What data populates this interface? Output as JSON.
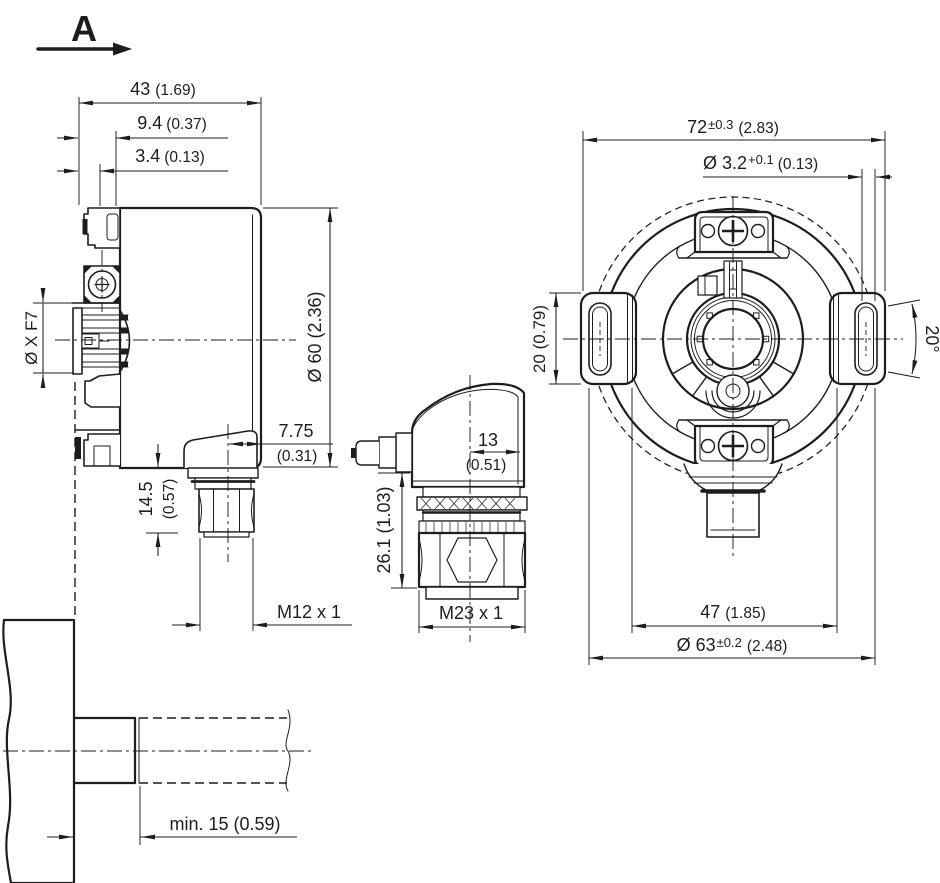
{
  "drawing": {
    "type": "dimensional-drawing",
    "subject": "incremental-encoder-hollow-shaft",
    "units": "mm (inch)",
    "colors": {
      "line": "#1d1d1b",
      "background": "#ffffff"
    }
  },
  "view_label": {
    "letter": "A"
  },
  "side_view": {
    "dims": {
      "width_43": {
        "mm": "43",
        "inch": "(1.69)"
      },
      "depth_9_4": {
        "mm": "9.4",
        "inch": "(0.37)"
      },
      "depth_3_4": {
        "mm": "3.4",
        "inch": "(0.13)"
      },
      "bore": {
        "label": "Ø X F7"
      },
      "diameter_60": {
        "label": "Ø 60 (2.36)"
      },
      "conn_offset_7_75": {
        "mm": "7.75",
        "inch": "(0.31)"
      },
      "conn_len_14_5": {
        "mm": "14.5",
        "inch": "(0.57)"
      },
      "thread_m12": {
        "label": "M12 x 1"
      }
    }
  },
  "connector_view": {
    "dims": {
      "width_13": {
        "mm": "13",
        "inch": "(0.51)"
      },
      "height_26_1": {
        "label": "26.1 (1.03)"
      },
      "thread_m23": {
        "label": "M23 x 1"
      }
    }
  },
  "front_view": {
    "dims": {
      "width_72": {
        "mm": "72",
        "tol": "±0.3",
        "inch": "(2.83)"
      },
      "hole_3_2": {
        "mm": "Ø 3.2",
        "tol": "+0.1",
        "inch": "(0.13)"
      },
      "lug_height_20": {
        "label": "20 (0.79)"
      },
      "angle_20": {
        "label": "20°"
      },
      "spacing_47": {
        "mm": "47",
        "inch": "(1.85)"
      },
      "diameter_63": {
        "mm": "Ø 63",
        "tol": "±0.2",
        "inch": "(2.48)"
      }
    }
  },
  "shaft_view": {
    "dims": {
      "min_insertion": {
        "label": "min. 15 (0.59)"
      }
    }
  }
}
